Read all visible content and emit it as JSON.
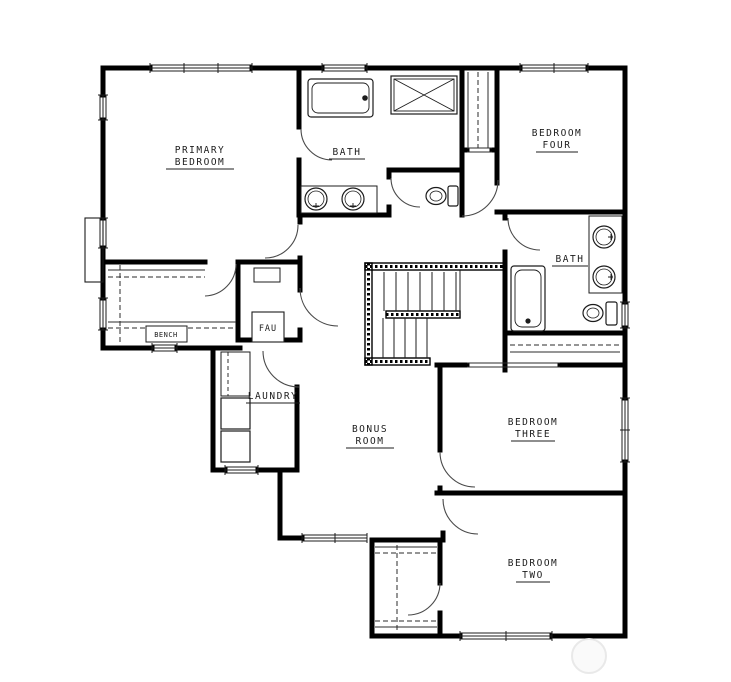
{
  "drawing": {
    "type": "floor-plan",
    "paper_color": "#ffffff",
    "wall_color": "#000000",
    "line_color": "#3a3a3a",
    "watermark_color": "#e9e9e9"
  },
  "rooms": {
    "primary_bedroom": {
      "line1": "PRIMARY",
      "line2": "BEDROOM"
    },
    "primary_bath": {
      "line1": "BATH"
    },
    "bedroom_four": {
      "line1": "BEDROOM",
      "line2": "FOUR"
    },
    "shared_bath": {
      "line1": "BATH"
    },
    "bonus_room": {
      "line1": "BONUS",
      "line2": "ROOM"
    },
    "laundry": {
      "line1": "LAUNDRY"
    },
    "bedroom_three": {
      "line1": "BEDROOM",
      "line2": "THREE"
    },
    "bedroom_two": {
      "line1": "BEDROOM",
      "line2": "TWO"
    },
    "closet_bench": {
      "line1": "BENCH"
    },
    "fau_room": {
      "line1": "FAU"
    }
  }
}
